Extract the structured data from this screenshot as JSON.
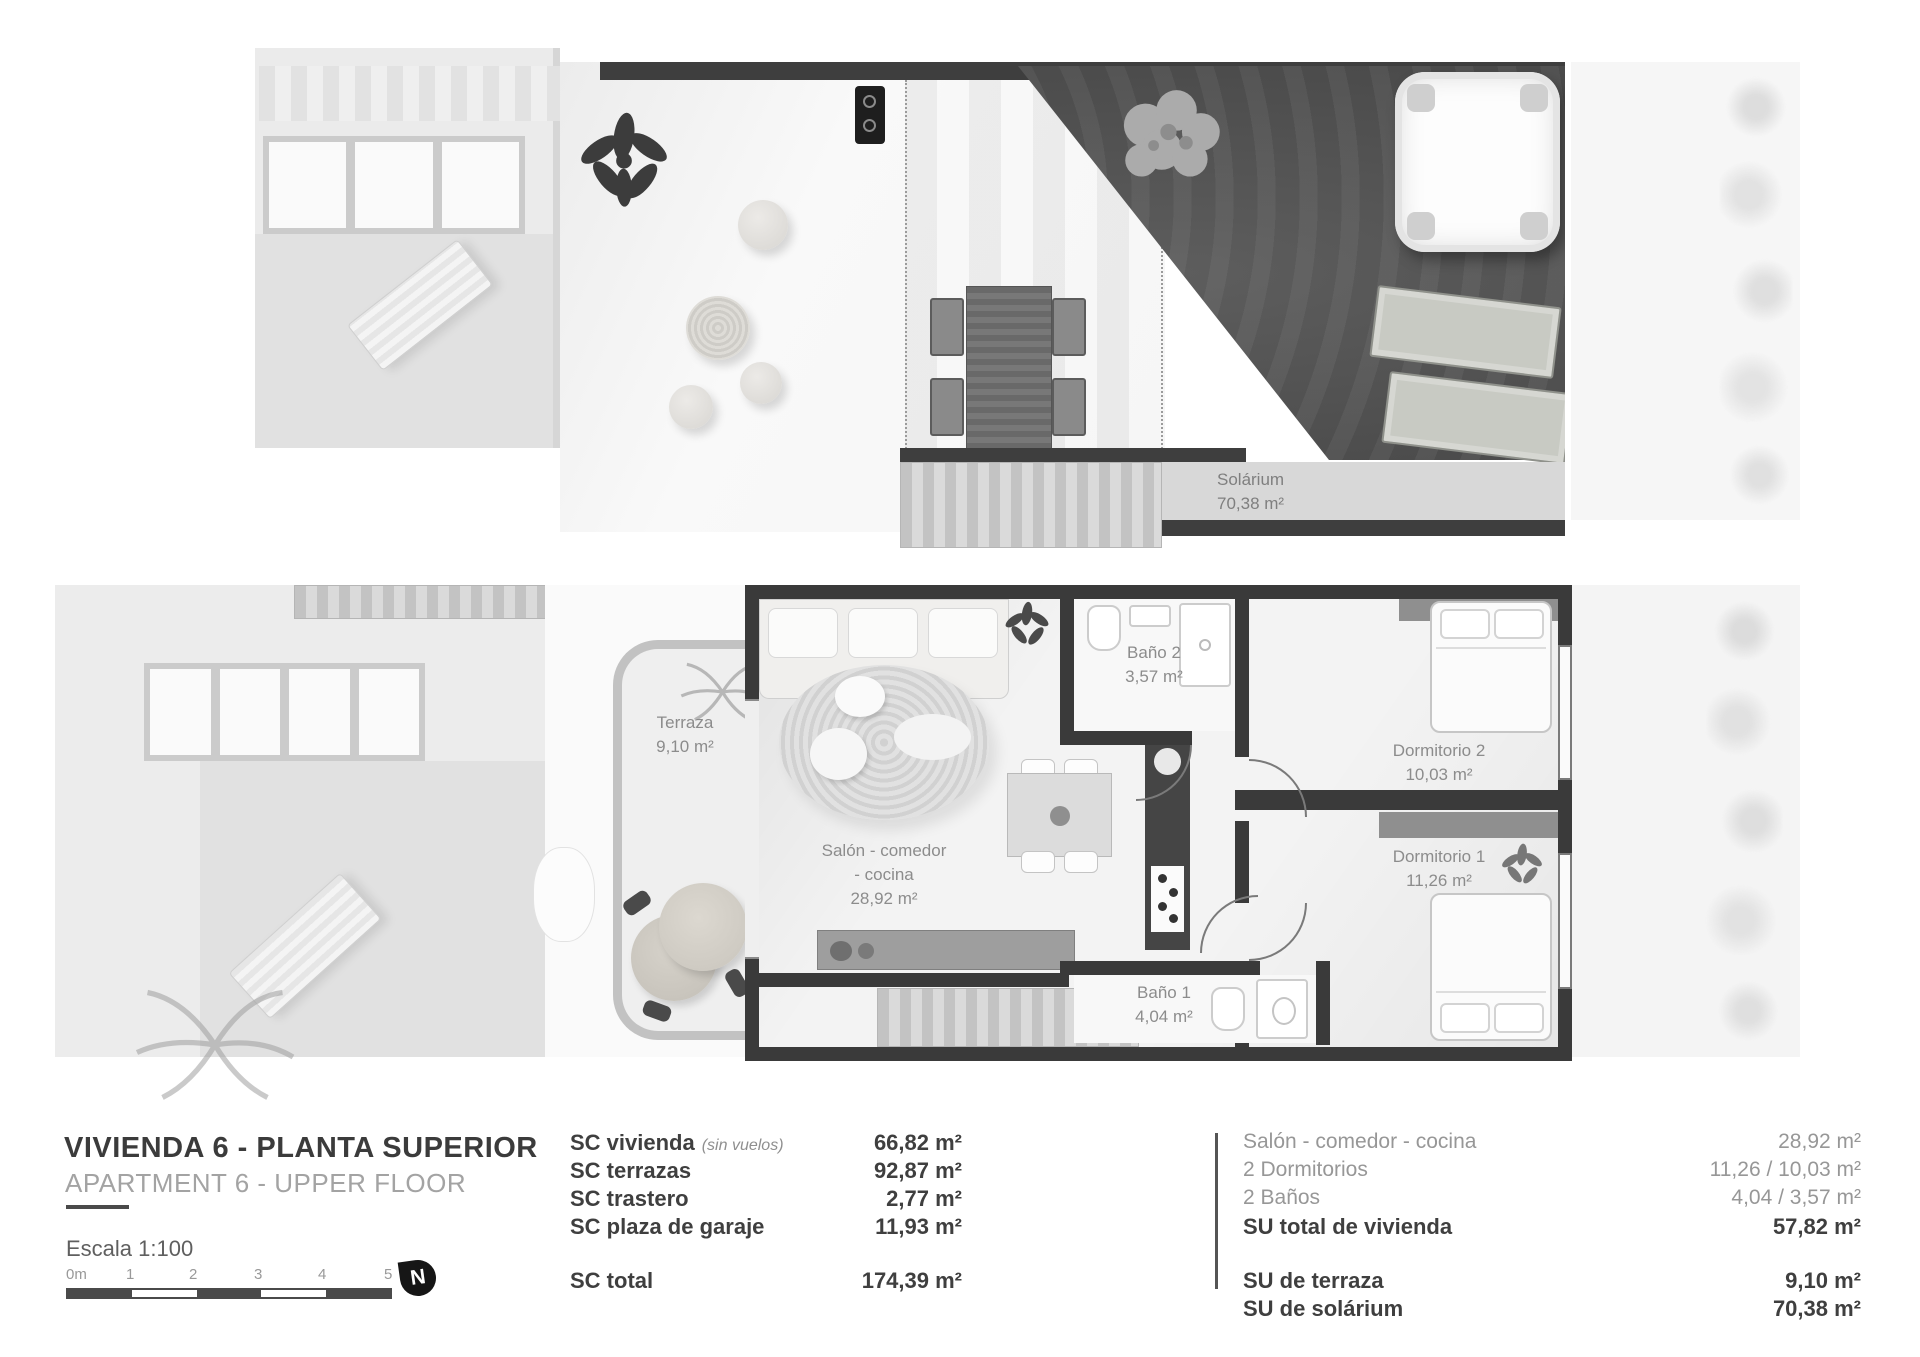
{
  "colors": {
    "wall_dark": "#3a3a3a",
    "solarium_floor": "#4f4f4f",
    "garden_light": "#ebebeb",
    "room_label_text": "#8c8c8c",
    "title_text": "#3b3b3b",
    "muted_text": "#a3a3a3"
  },
  "title_block": {
    "title": "VIVIENDA 6 - PLANTA SUPERIOR",
    "subtitle": "APARTMENT 6 - UPPER FLOOR",
    "scale_label": "Escala 1:100",
    "scale_ticks": [
      "0m",
      "1",
      "2",
      "3",
      "4",
      "5"
    ],
    "north_label": "N"
  },
  "sc_table": {
    "rows": [
      {
        "label": "SC vivienda",
        "note": "(sin vuelos)",
        "value": "66,82 m²"
      },
      {
        "label": "SC terrazas",
        "value": "92,87 m²"
      },
      {
        "label": "SC trastero",
        "value": "2,77 m²"
      },
      {
        "label": "SC plaza de garaje",
        "value": "11,93 m²"
      }
    ],
    "total": {
      "label": "SC total",
      "value": "174,39 m²"
    }
  },
  "su_table": {
    "rows": [
      {
        "label": "Salón - comedor - cocina",
        "value": "28,92 m²"
      },
      {
        "label": "2 Dormitorios",
        "value": "11,26 / 10,03 m²"
      },
      {
        "label": "2 Baños",
        "value": "4,04 / 3,57 m²"
      },
      {
        "label": "SU total de vivienda",
        "value": "57,82 m²"
      }
    ],
    "extra": [
      {
        "label": "SU de terraza",
        "value": "9,10 m²"
      },
      {
        "label": "SU de solárium",
        "value": "70,38 m²"
      }
    ]
  },
  "rooms": {
    "solarium": {
      "name": "Solárium",
      "area": "70,38 m²"
    },
    "terraza": {
      "name": "Terraza",
      "area": "9,10 m²"
    },
    "salon": {
      "line1": "Salón - comedor",
      "line2": "- cocina",
      "area": "28,92 m²"
    },
    "bano2": {
      "name": "Baño 2",
      "area": "3,57 m²"
    },
    "bano1": {
      "name": "Baño 1",
      "area": "4,04 m²"
    },
    "dorm2": {
      "name": "Dormitorio 2",
      "area": "10,03 m²"
    },
    "dorm1": {
      "name": "Dormitorio 1",
      "area": "11,26 m²"
    }
  }
}
